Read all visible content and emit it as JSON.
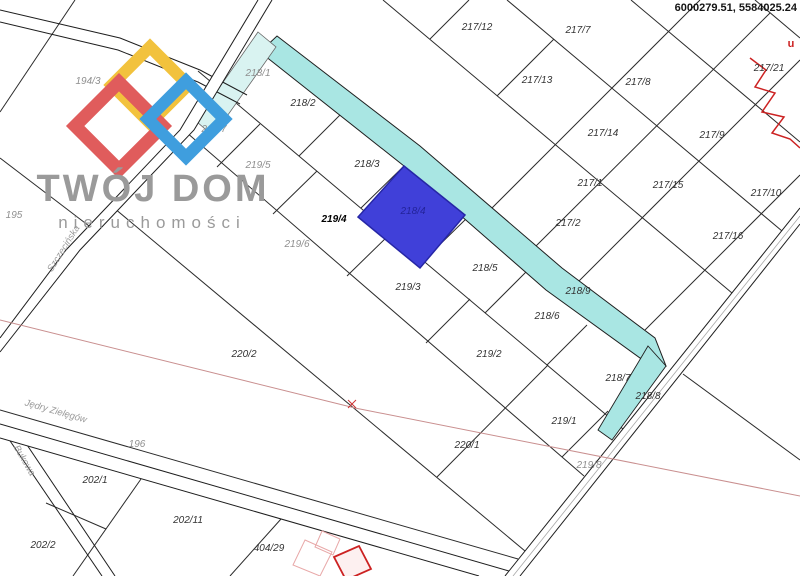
{
  "map": {
    "coordinates_label": "6000279.51, 5584025.24",
    "highlighted_parcel": "218/4",
    "red_annotation": "u",
    "colors": {
      "highlight_fill": "#4040d9",
      "highlight_stroke": "#2626a6",
      "waterway_strip": "#a9e6e3",
      "waterway_strip_light": "#d9f3f1",
      "red_boundary_line": "#c98f8f",
      "red_detail": "#cc2222",
      "parcel_line": "#2b2b2b",
      "logo_gray": "#9a9a9a",
      "logo_red": "#e05c5c",
      "logo_yellow": "#f2c23d",
      "logo_blue": "#3f9ede"
    },
    "parcel_labels": [
      {
        "text": "194/3",
        "x": 88,
        "y": 84,
        "cls": "gray"
      },
      {
        "text": "195",
        "x": 14,
        "y": 218,
        "cls": "gray"
      },
      {
        "text": "196",
        "x": 137,
        "y": 447,
        "cls": "gray"
      },
      {
        "text": "218/1",
        "x": 258,
        "y": 76,
        "cls": "gray"
      },
      {
        "text": "219/7",
        "x": 214,
        "y": 132,
        "cls": "gray"
      },
      {
        "text": "219/5",
        "x": 258,
        "y": 168,
        "cls": "gray"
      },
      {
        "text": "219/6",
        "x": 297,
        "y": 247,
        "cls": "gray"
      },
      {
        "text": "218/2",
        "x": 303,
        "y": 106,
        "cls": "dark"
      },
      {
        "text": "218/3",
        "x": 367,
        "y": 167,
        "cls": "dark"
      },
      {
        "text": "218/4",
        "x": 413,
        "y": 214,
        "cls": "onblue"
      },
      {
        "text": "218/5",
        "x": 485,
        "y": 271,
        "cls": "dark"
      },
      {
        "text": "218/9",
        "x": 578,
        "y": 294,
        "cls": "dark"
      },
      {
        "text": "218/6",
        "x": 547,
        "y": 319,
        "cls": "dark"
      },
      {
        "text": "218/7",
        "x": 618,
        "y": 381,
        "cls": "dark"
      },
      {
        "text": "218/8",
        "x": 648,
        "y": 399,
        "cls": "dark"
      },
      {
        "text": "219/4",
        "x": 334,
        "y": 222,
        "cls": "bold"
      },
      {
        "text": "219/3",
        "x": 408,
        "y": 290,
        "cls": "dark"
      },
      {
        "text": "219/2",
        "x": 489,
        "y": 357,
        "cls": "dark"
      },
      {
        "text": "219/1",
        "x": 564,
        "y": 424,
        "cls": "dark"
      },
      {
        "text": "219/8",
        "x": 589,
        "y": 468,
        "cls": "gray"
      },
      {
        "text": "220/2",
        "x": 244,
        "y": 357,
        "cls": "dark"
      },
      {
        "text": "220/1",
        "x": 467,
        "y": 448,
        "cls": "dark"
      },
      {
        "text": "202/1",
        "x": 95,
        "y": 483,
        "cls": "dark"
      },
      {
        "text": "202/11",
        "x": 188,
        "y": 523,
        "cls": "dark"
      },
      {
        "text": "202/2",
        "x": 43,
        "y": 548,
        "cls": "dark"
      },
      {
        "text": "404/29",
        "x": 269,
        "y": 551,
        "cls": "dark"
      },
      {
        "text": "217/12",
        "x": 477,
        "y": 30,
        "cls": "dark"
      },
      {
        "text": "217/7",
        "x": 578,
        "y": 33,
        "cls": "dark"
      },
      {
        "text": "217/13",
        "x": 537,
        "y": 83,
        "cls": "dark"
      },
      {
        "text": "217/8",
        "x": 638,
        "y": 85,
        "cls": "dark"
      },
      {
        "text": "217/21",
        "x": 769,
        "y": 71,
        "cls": "dark"
      },
      {
        "text": "217/14",
        "x": 603,
        "y": 136,
        "cls": "dark"
      },
      {
        "text": "217/9",
        "x": 712,
        "y": 138,
        "cls": "dark"
      },
      {
        "text": "217/1",
        "x": 590,
        "y": 186,
        "cls": "dark"
      },
      {
        "text": "217/15",
        "x": 668,
        "y": 188,
        "cls": "dark"
      },
      {
        "text": "217/10",
        "x": 766,
        "y": 196,
        "cls": "dark"
      },
      {
        "text": "217/2",
        "x": 568,
        "y": 226,
        "cls": "dark"
      },
      {
        "text": "217/16",
        "x": 728,
        "y": 239,
        "cls": "dark"
      }
    ],
    "street_labels": [
      {
        "text": "Szczecińska",
        "x": 66,
        "y": 250,
        "rot": -58
      },
      {
        "text": "Bukowa",
        "x": 22,
        "y": 462,
        "rot": 60
      },
      {
        "text": "Jędry Zielęgów",
        "x": 55,
        "y": 414,
        "rot": 16
      }
    ]
  },
  "logo": {
    "title": "TWÓJ DOM",
    "subtitle": "nieruchomości"
  }
}
